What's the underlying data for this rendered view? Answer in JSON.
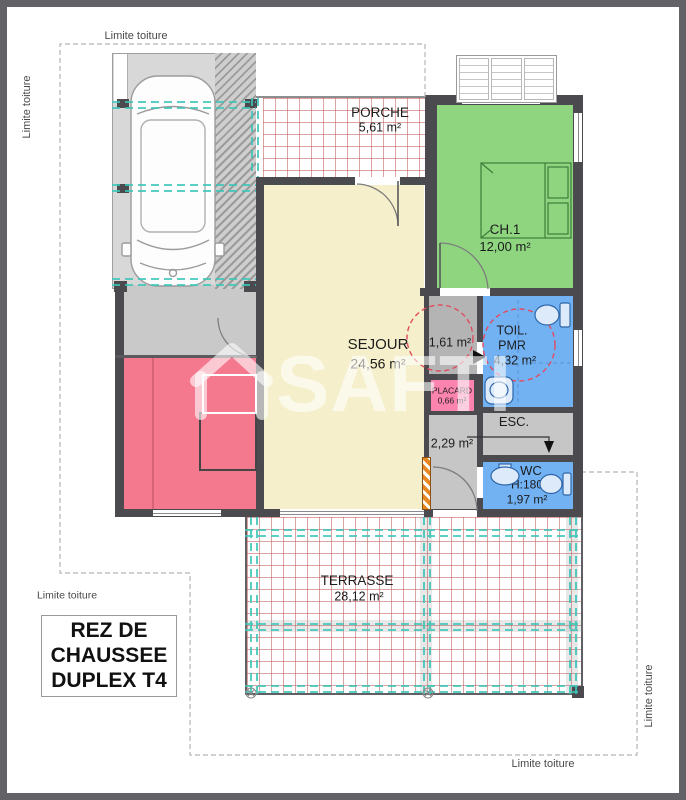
{
  "watermark": {
    "brand": "SAFTI"
  },
  "boundary": {
    "top": "Limite toiture",
    "left": "Limite toiture",
    "bottom_left": "Limite toiture",
    "bottom": "Limite toiture",
    "right": "Limite toiture"
  },
  "title_block": {
    "line1": "REZ DE",
    "line2": "CHAUSSEE",
    "line3": "DUPLEX T4"
  },
  "rooms": {
    "carport": {
      "line1": "Abri",
      "line2": "Voiture",
      "line3": "Couvert",
      "area": "18,25 m²"
    },
    "porche": {
      "name": "PORCHE",
      "area": "5,61 m²"
    },
    "ch1": {
      "name": "CH.1",
      "area": "12,00 m²"
    },
    "sejour": {
      "name": "SEJOUR",
      "area": "24,56 m²"
    },
    "hall": {
      "area": "1,61 m²"
    },
    "toil_pmr": {
      "line1": "TOIL.",
      "line2": "PMR",
      "area": "4,32 m²"
    },
    "placard": {
      "name": "PLACARD",
      "area": "0,66 m²"
    },
    "degagement": {
      "area": "2,29 m²"
    },
    "esc": {
      "name": "ESC."
    },
    "wc": {
      "name": "WC",
      "height": "H:180",
      "area": "1,97 m²"
    },
    "terrasse": {
      "name": "TERRASSE",
      "area": "28,12 m²"
    }
  },
  "colors": {
    "frame": "#636367",
    "walls": "#4b4b4f",
    "sejour_fill": "#f5efcb",
    "ch1_fill": "#8fd57f",
    "cuisine_fill": "#f4798f",
    "placard_fill": "#fb84ae",
    "wet_room_fill": "#72b2f3",
    "hall_fill": "#c9c9c9",
    "carport_fill": "#d8d8d8",
    "tile_grid": "#c05858",
    "roof_beam_teal": "#3cc6b8",
    "pmr_circle_red": "#e14b60",
    "duct_orange": "#e8871f"
  }
}
